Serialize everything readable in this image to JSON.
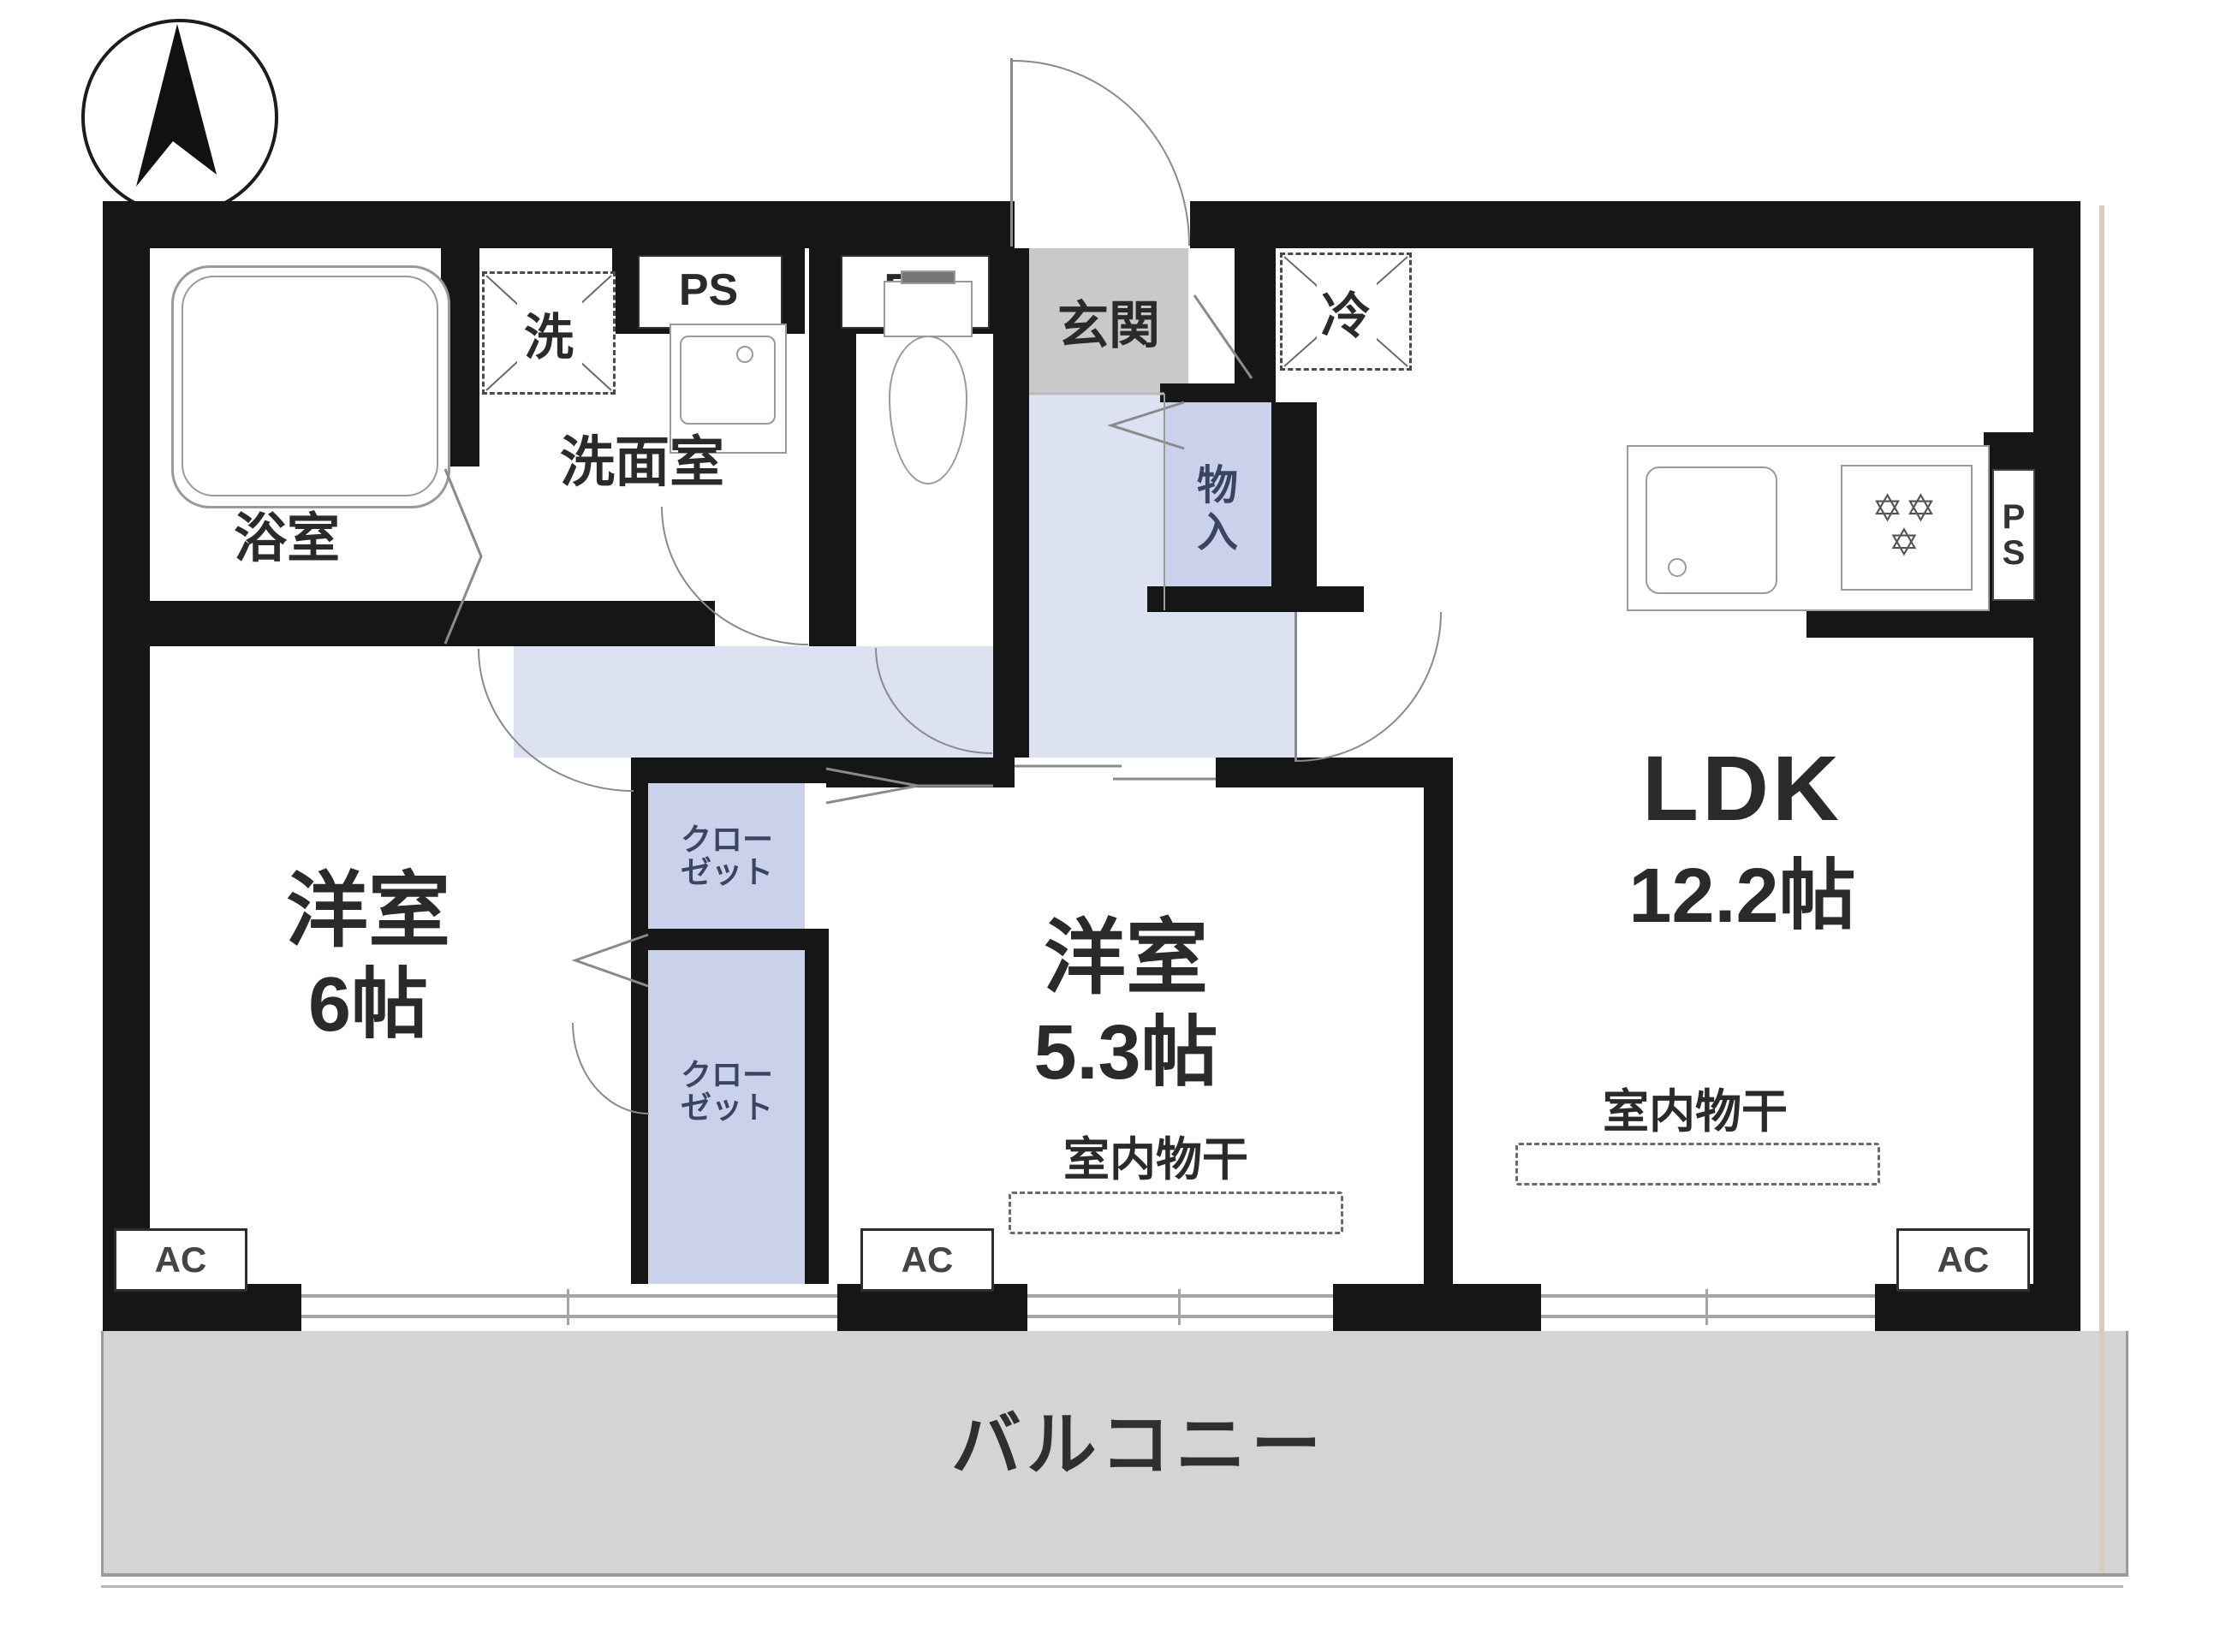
{
  "plan": {
    "title_hint": "apartment-floor-plan",
    "compass_icon": "north-arrow",
    "rooms": {
      "bath": {
        "label": "浴室"
      },
      "washer": {
        "label": "洗"
      },
      "washroom": {
        "label": "洗面室"
      },
      "entrance": {
        "label": "玄関"
      },
      "fridge": {
        "label": "冷"
      },
      "storage": {
        "label": "物入"
      },
      "ldk": {
        "name": "LDK",
        "size": "12.2帖"
      },
      "western6": {
        "name": "洋室",
        "size": "6帖"
      },
      "western53": {
        "name": "洋室",
        "size": "5.3帖"
      },
      "closet": {
        "line1": "クロー",
        "line2": "ゼット"
      },
      "balcony": {
        "label": "バルコニー"
      }
    },
    "labels": {
      "pipe_space": "PS",
      "air_conditioner": "AC",
      "indoor_drying": "室内物干"
    },
    "colors": {
      "wall": "#161616",
      "hallway": "#dce2f1",
      "closet": "#c9d2ea",
      "entrance_floor": "#c9c9c9",
      "balcony_floor": "#d4d4d4",
      "fixture_line": "#9a9a9a",
      "side_strip": "#d5cdbd"
    }
  }
}
